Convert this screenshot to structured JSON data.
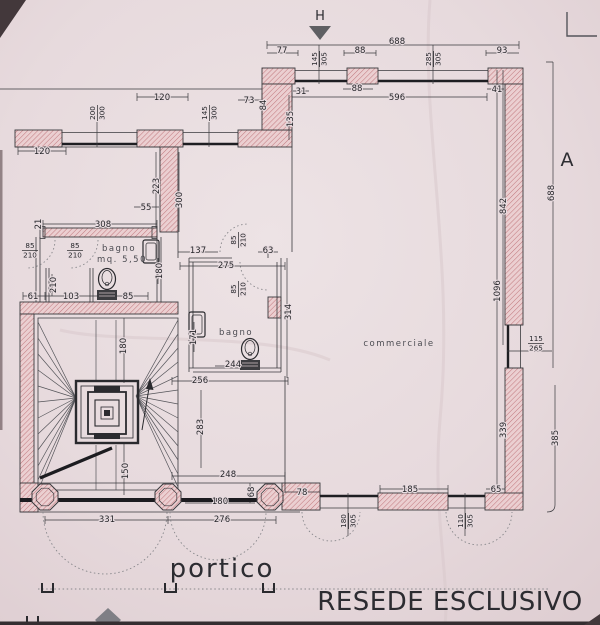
{
  "palette": {
    "paper": "#e8dce0",
    "wall_fill": "#ecd0d2",
    "wall_hatch": "#c0767c",
    "line": "#3a3a3e",
    "text": "#26262a",
    "marker": "#5f5f63"
  },
  "titles": {
    "resede": "RESEDE ESCLUSIVO",
    "portico": "portico",
    "section_h": "H",
    "section_a": "A"
  },
  "rooms": [
    {
      "label": "bagno",
      "x": 119,
      "y": 251
    },
    {
      "label": "mq. 5,50",
      "x": 122,
      "y": 262
    },
    {
      "label": "bagno",
      "x": 236,
      "y": 335
    },
    {
      "label": "commerciale",
      "x": 399,
      "y": 346
    }
  ],
  "dimensions": [
    {
      "t": "688",
      "x": 397,
      "y": 41,
      "r": 0
    },
    {
      "t": "77",
      "x": 282,
      "y": 50,
      "r": 0
    },
    {
      "t": "88",
      "x": 360,
      "y": 50,
      "r": 0
    },
    {
      "t": "93",
      "x": 502,
      "y": 50,
      "r": 0
    },
    {
      "t": "88",
      "x": 357,
      "y": 88,
      "r": 0
    },
    {
      "t": "596",
      "x": 397,
      "y": 97,
      "r": 0
    },
    {
      "t": "41",
      "x": 497,
      "y": 89,
      "r": 0
    },
    {
      "t": "120",
      "x": 162,
      "y": 97,
      "r": 0
    },
    {
      "t": "73",
      "x": 249,
      "y": 100,
      "r": 0
    },
    {
      "t": "84",
      "x": 263,
      "y": 105,
      "r": -90
    },
    {
      "t": "31",
      "x": 301,
      "y": 91,
      "r": 0
    },
    {
      "t": "135",
      "x": 290,
      "y": 119,
      "r": -90
    },
    {
      "t": "120",
      "x": 42,
      "y": 151,
      "r": 0
    },
    {
      "t": "55",
      "x": 146,
      "y": 207,
      "r": 0
    },
    {
      "t": "223",
      "x": 156,
      "y": 186,
      "r": -90
    },
    {
      "t": "300",
      "x": 179,
      "y": 200,
      "r": -90
    },
    {
      "t": "308",
      "x": 103,
      "y": 224,
      "r": 0
    },
    {
      "t": "21",
      "x": 38,
      "y": 224,
      "r": -90
    },
    {
      "t": "61",
      "x": 33,
      "y": 296,
      "r": 0
    },
    {
      "t": "103",
      "x": 71,
      "y": 296,
      "r": 0
    },
    {
      "t": "85",
      "x": 128,
      "y": 296,
      "r": 0
    },
    {
      "t": "210",
      "x": 53,
      "y": 285,
      "r": -90
    },
    {
      "t": "180",
      "x": 159,
      "y": 271,
      "r": -90
    },
    {
      "t": "137",
      "x": 198,
      "y": 250,
      "r": 0
    },
    {
      "t": "63",
      "x": 268,
      "y": 250,
      "r": 0
    },
    {
      "t": "275",
      "x": 226,
      "y": 265,
      "r": 0
    },
    {
      "t": "314",
      "x": 288,
      "y": 312,
      "r": -90
    },
    {
      "t": "171",
      "x": 193,
      "y": 337,
      "r": -90
    },
    {
      "t": "244",
      "x": 233,
      "y": 364,
      "r": 0
    },
    {
      "t": "256",
      "x": 200,
      "y": 380,
      "r": 0
    },
    {
      "t": "283",
      "x": 200,
      "y": 427,
      "r": -90
    },
    {
      "t": "248",
      "x": 228,
      "y": 474,
      "r": 0
    },
    {
      "t": "180",
      "x": 123,
      "y": 346,
      "r": -90
    },
    {
      "t": "150",
      "x": 125,
      "y": 471,
      "r": -90
    },
    {
      "t": "180",
      "x": 220,
      "y": 501,
      "r": 0
    },
    {
      "t": "68",
      "x": 251,
      "y": 492,
      "r": -90
    },
    {
      "t": "331",
      "x": 107,
      "y": 519,
      "r": 0
    },
    {
      "t": "276",
      "x": 222,
      "y": 519,
      "r": 0
    },
    {
      "t": "78",
      "x": 302,
      "y": 492,
      "r": 0
    },
    {
      "t": "185",
      "x": 410,
      "y": 489,
      "r": 0
    },
    {
      "t": "65",
      "x": 496,
      "y": 489,
      "r": 0
    },
    {
      "t": "842",
      "x": 503,
      "y": 206,
      "r": -90
    },
    {
      "t": "1096",
      "x": 497,
      "y": 291,
      "r": -90
    },
    {
      "t": "688",
      "x": 551,
      "y": 193,
      "r": -90
    },
    {
      "t": "385",
      "x": 555,
      "y": 438,
      "r": -90
    },
    {
      "t": "339",
      "x": 503,
      "y": 430,
      "r": -90
    }
  ],
  "fractions": [
    {
      "a": "145",
      "b": "305",
      "x": 319,
      "y": 59,
      "r": -90
    },
    {
      "a": "285",
      "b": "305",
      "x": 433,
      "y": 59,
      "r": -90
    },
    {
      "a": "200",
      "b": "300",
      "x": 97,
      "y": 113,
      "r": -90
    },
    {
      "a": "145",
      "b": "300",
      "x": 209,
      "y": 113,
      "r": -90
    },
    {
      "a": "85",
      "b": "210",
      "x": 30,
      "y": 250,
      "r": 0
    },
    {
      "a": "85",
      "b": "210",
      "x": 75,
      "y": 250,
      "r": 0
    },
    {
      "a": "85",
      "b": "210",
      "x": 238,
      "y": 240,
      "r": -90
    },
    {
      "a": "85",
      "b": "210",
      "x": 238,
      "y": 289,
      "r": -90
    },
    {
      "a": "115",
      "b": "265",
      "x": 536,
      "y": 343,
      "r": 0
    },
    {
      "a": "180",
      "b": "305",
      "x": 348,
      "y": 521,
      "r": -90
    },
    {
      "a": "110",
      "b": "305",
      "x": 465,
      "y": 521,
      "r": -90
    }
  ]
}
